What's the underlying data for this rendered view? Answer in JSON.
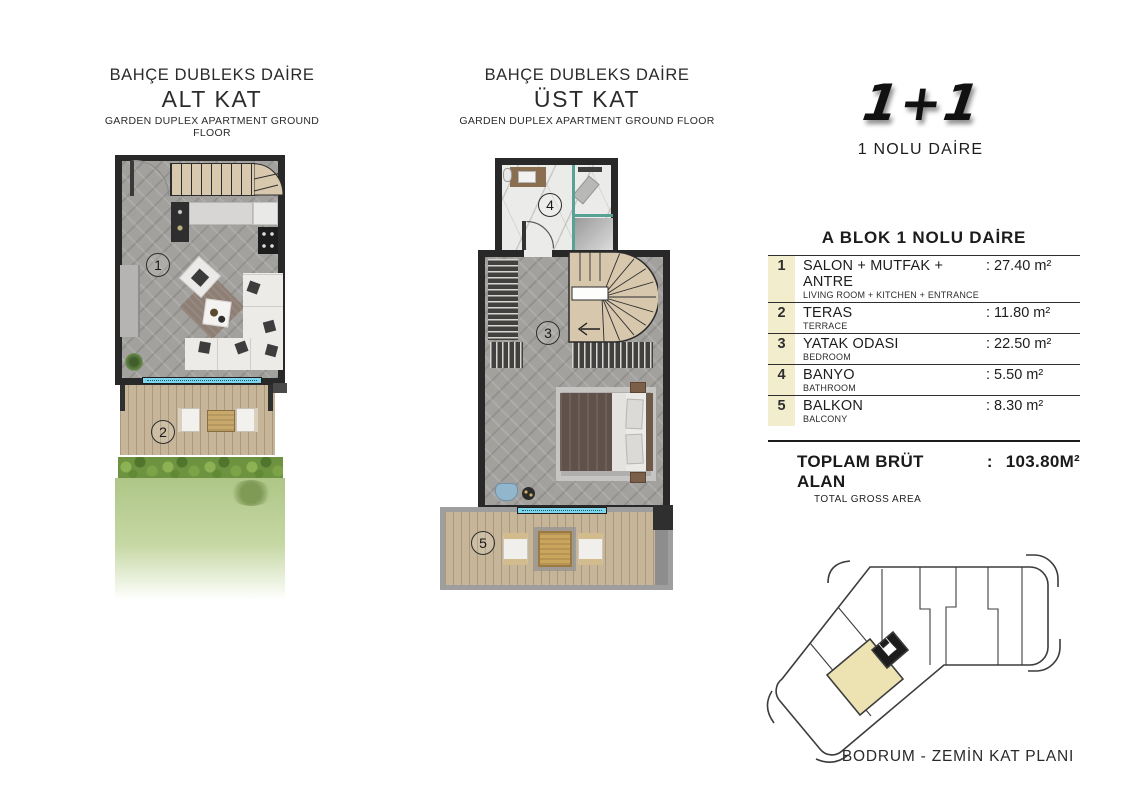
{
  "colors": {
    "wall": "#282828",
    "floor-gray": "#a3a19e",
    "stair-beige": "#d8c8ae",
    "deck-wood": "#c7b59a",
    "window-blue": "#7fd6ec",
    "hedge-green": "#6d9340",
    "marble": "#ebebe9",
    "glass-teal": "#57a295",
    "highlight-cream": "#ede3b2",
    "table-num-bg": "#f2eecd",
    "gold": "#c9a55e"
  },
  "plans": {
    "lower": {
      "title": "BAHÇE DUBLEKS DAİRE",
      "subtitle": "ALT KAT",
      "subtext": "GARDEN DUPLEX APARTMENT GROUND FLOOR",
      "labels": {
        "living": "1",
        "terrace": "2"
      }
    },
    "upper": {
      "title": "BAHÇE DUBLEKS DAİRE",
      "subtitle": "ÜST KAT",
      "subtext": "GARDEN DUPLEX APARTMENT GROUND FLOOR",
      "labels": {
        "bedroom": "3",
        "bathroom": "4",
        "balcony": "5"
      }
    }
  },
  "unit": {
    "type": "1+1",
    "name": "1 NOLU DAİRE",
    "table_title": "A BLOK 1 NOLU DAİRE",
    "rows": [
      {
        "num": "1",
        "tr": "SALON + MUTFAK + ANTRE",
        "en": "LIVING ROOM + KITCHEN + ENTRANCE",
        "area": ": 27.40 m²"
      },
      {
        "num": "2",
        "tr": "TERAS",
        "en": "TERRACE",
        "area": ": 11.80 m²"
      },
      {
        "num": "3",
        "tr": "YATAK ODASI",
        "en": "BEDROOM",
        "area": ": 22.50 m²"
      },
      {
        "num": "4",
        "tr": "BANYO",
        "en": "BATHROOM",
        "area": ": 5.50 m²"
      },
      {
        "num": "5",
        "tr": "BALKON",
        "en": "BALCONY",
        "area": ": 8.30 m²"
      }
    ],
    "total": {
      "label": "TOPLAM BRÜT ALAN",
      "colon": ":",
      "value": "103.80M²",
      "sub": "TOTAL GROSS AREA"
    }
  },
  "key_plan": {
    "caption": "BODRUM - ZEMİN KAT PLANI"
  }
}
